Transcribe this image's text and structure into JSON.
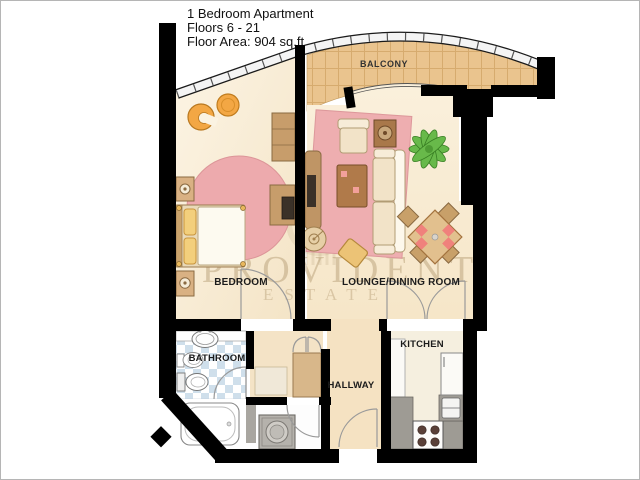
{
  "header": {
    "line1": "1 Bedroom Apartment",
    "line2": "Floors 6 - 21",
    "line3": "Floor Area: 904 sq.ft."
  },
  "rooms": {
    "balcony": "BALCONY",
    "bedroom": "BEDROOM",
    "lounge": "LOUNGE/DINING ROOM",
    "bathroom": "BATHROOM",
    "hallway": "HALLWAY",
    "kitchen": "KITCHEN"
  },
  "watermark": {
    "line1": "PROVIDENT",
    "line2": "ESTATE"
  },
  "colors": {
    "wall": "#000000",
    "floor_cream": "#f8eeda",
    "hall_beige": "#f5e2c2",
    "balcony_tan": "#eac48e",
    "rug_pink": "#edaaad",
    "tile_blue": "#cfdfeb",
    "counter_gray": "#9e9b94",
    "plant_green": "#68b94a",
    "chair_orange": "#f3a744",
    "watermark_tan": "#b8a078"
  }
}
